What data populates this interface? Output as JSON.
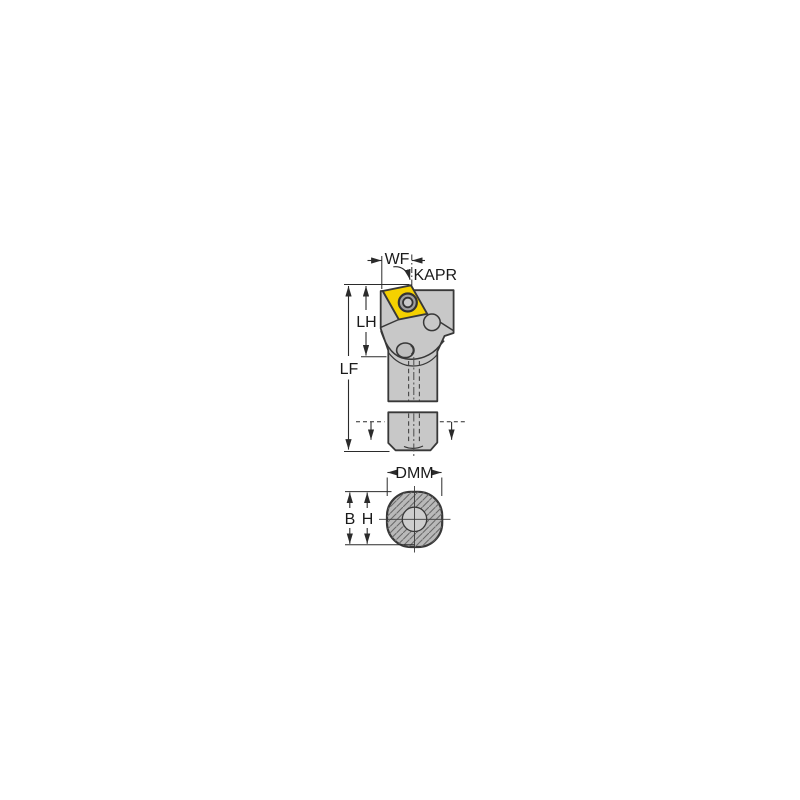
{
  "diagram": {
    "title": "Boring bar tool holder dimension drawing",
    "views": {
      "side_view": "tool holder with indexable insert, side elevation with break lines",
      "cross_section": "round shank cross-section with centre bore, diagonal hatching"
    },
    "labels": {
      "wf": "WF",
      "kapr": "KAPR",
      "lh": "LH",
      "lf": "LF",
      "dmm": "DMM",
      "b": "B",
      "h": "H"
    },
    "colors": {
      "insert": "#F5D100",
      "body": "#C8C8C8",
      "section_fill": "#B9B9B9",
      "section_bore": "#CDCDCD",
      "outline": "#383838",
      "dimension": "#2B2B2B"
    }
  }
}
